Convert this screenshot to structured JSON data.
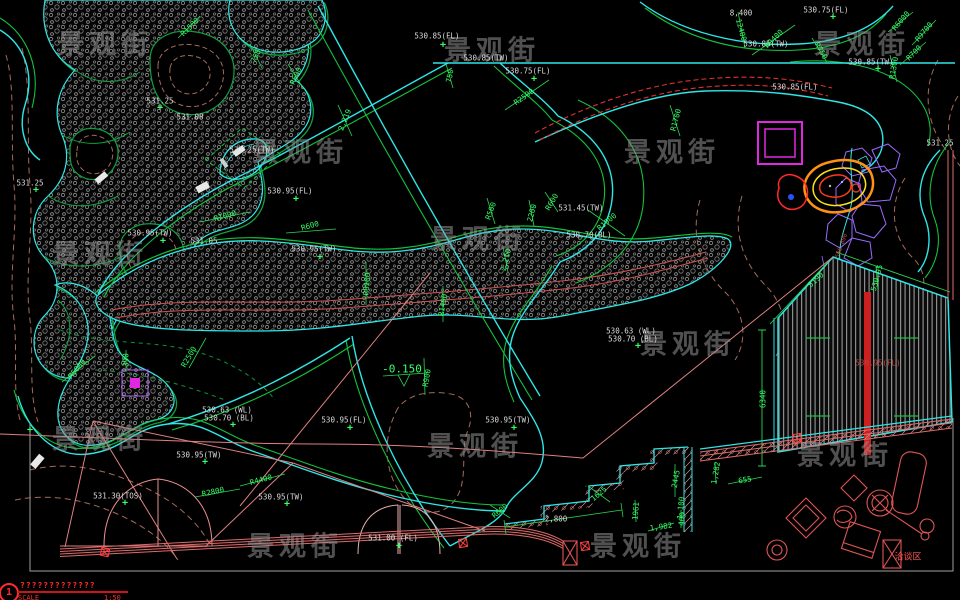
{
  "app": {
    "type": "cad-landscape-site-plan",
    "canvas_w": 960,
    "canvas_h": 600
  },
  "colors": {
    "background": "#000000",
    "edge_cyan": "#2ee6e6",
    "edge_green": "#12c23c",
    "label_green": "#35ff6a",
    "label_white": "#dcdcdc",
    "title_red": "#ff2a2a",
    "wall_pink": "#e06a6a",
    "contour_brown": "#a66a5a",
    "planter_magenta": "#e028e0",
    "rock_purple": "#9a6cff",
    "rock_orange": "#ff9114",
    "rock_yellow": "#ffe01a",
    "deck_red_band": "#cc2020",
    "watermark_gray": "#7a7a7a"
  },
  "watermark": {
    "text": "景观街",
    "positions": [
      [
        105,
        42
      ],
      [
        300,
        150
      ],
      [
        492,
        48
      ],
      [
        672,
        150
      ],
      [
        862,
        42
      ],
      [
        100,
        252
      ],
      [
        478,
        237
      ],
      [
        688,
        342
      ],
      [
        100,
        437
      ],
      [
        475,
        444
      ],
      [
        845,
        453
      ],
      [
        295,
        544
      ],
      [
        638,
        544
      ]
    ]
  },
  "title_block": {
    "sheet_no": "1",
    "glyph_row": "?????????????",
    "scale_label": "SCALE",
    "scale_value": "1:50"
  },
  "annotations": [
    {
      "t": "530.85(FL)",
      "x": 437,
      "y": 36,
      "c": "w"
    },
    {
      "t": "530.85(TW)",
      "x": 486,
      "y": 58,
      "c": "w"
    },
    {
      "t": "530.75(FL)",
      "x": 528,
      "y": 71,
      "c": "w"
    },
    {
      "t": "8,400",
      "x": 741,
      "y": 13,
      "c": "w"
    },
    {
      "t": "530.75(FL)",
      "x": 826,
      "y": 10,
      "c": "w"
    },
    {
      "t": "530.85(TW)",
      "x": 766,
      "y": 44,
      "c": "w"
    },
    {
      "t": "530.85(TW)",
      "x": 871,
      "y": 62,
      "c": "w"
    },
    {
      "t": "530.85(FL)",
      "x": 795,
      "y": 87,
      "c": "w"
    },
    {
      "t": "531.25",
      "x": 940,
      "y": 143,
      "c": "w"
    },
    {
      "t": "531.25",
      "x": 160,
      "y": 101,
      "c": "w"
    },
    {
      "t": "531.08",
      "x": 190,
      "y": 117,
      "c": "w"
    },
    {
      "t": "531.25(TW)",
      "x": 252,
      "y": 150,
      "c": "w"
    },
    {
      "t": "530.95(FL)",
      "x": 290,
      "y": 191,
      "c": "w"
    },
    {
      "t": "530.95(TW)",
      "x": 150,
      "y": 233,
      "c": "w"
    },
    {
      "t": "531.05",
      "x": 204,
      "y": 241,
      "c": "w"
    },
    {
      "t": "530.95(TW)",
      "x": 314,
      "y": 249,
      "c": "w"
    },
    {
      "t": "531.25",
      "x": 30,
      "y": 183,
      "c": "w"
    },
    {
      "t": "530.95(FL)",
      "x": 344,
      "y": 420,
      "c": "w"
    },
    {
      "t": "530.95(TW)",
      "x": 508,
      "y": 420,
      "c": "w"
    },
    {
      "t": "531.00 (FL)",
      "x": 393,
      "y": 538,
      "c": "w"
    },
    {
      "t": "530.63 (WL)",
      "x": 227,
      "y": 410,
      "c": "w"
    },
    {
      "t": "530.70 (BL)",
      "x": 229,
      "y": 418,
      "c": "w"
    },
    {
      "t": "530.63 (WL)",
      "x": 631,
      "y": 331,
      "c": "w"
    },
    {
      "t": "530.70 (BL)",
      "x": 633,
      "y": 339,
      "c": "w"
    },
    {
      "t": "530.95(TW)",
      "x": 199,
      "y": 455,
      "c": "w"
    },
    {
      "t": "530.95(TW)",
      "x": 281,
      "y": 497,
      "c": "w"
    },
    {
      "t": "531.30(TOS)",
      "x": 118,
      "y": 496,
      "c": "w"
    },
    {
      "t": "531.45(TW)",
      "x": 581,
      "y": 208,
      "c": "w"
    },
    {
      "t": "530.70(BL)",
      "x": 589,
      "y": 235,
      "c": "w"
    },
    {
      "t": "2,800",
      "x": 556,
      "y": 519,
      "c": "w"
    },
    {
      "t": "R2500",
      "x": 524,
      "y": 97,
      "c": "g",
      "r": -35
    },
    {
      "t": "R900",
      "x": 427,
      "y": 378,
      "c": "g",
      "r": -80
    },
    {
      "t": "-0.150",
      "x": 402,
      "y": 369,
      "c": "g",
      "s": 11
    },
    {
      "t": "R600",
      "x": 310,
      "y": 226,
      "c": "g",
      "r": -15
    },
    {
      "t": "R1000",
      "x": 225,
      "y": 216,
      "c": "g",
      "r": -15
    },
    {
      "t": "R8100",
      "x": 367,
      "y": 284,
      "c": "g",
      "r": -85
    },
    {
      "t": "R1400",
      "x": 443,
      "y": 305,
      "c": "g",
      "r": -80
    },
    {
      "t": "R500",
      "x": 491,
      "y": 211,
      "c": "g",
      "r": -70
    },
    {
      "t": "2,210",
      "x": 506,
      "y": 260,
      "c": "g",
      "r": -75
    },
    {
      "t": "R1900",
      "x": 607,
      "y": 222,
      "c": "g",
      "r": -40
    },
    {
      "t": "R600",
      "x": 552,
      "y": 202,
      "c": "g",
      "r": -60
    },
    {
      "t": "2200",
      "x": 532,
      "y": 213,
      "c": "g",
      "r": -75
    },
    {
      "t": "R2800",
      "x": 213,
      "y": 492,
      "c": "g",
      "r": -12
    },
    {
      "t": "R4400",
      "x": 261,
      "y": 480,
      "c": "g",
      "r": -15
    },
    {
      "t": "R600",
      "x": 500,
      "y": 511,
      "c": "g",
      "r": -40
    },
    {
      "t": "1625",
      "x": 599,
      "y": 494,
      "c": "g",
      "r": -40
    },
    {
      "t": "1961",
      "x": 636,
      "y": 511,
      "c": "g",
      "r": -85
    },
    {
      "t": "1,982",
      "x": 661,
      "y": 527,
      "c": "g",
      "r": -8
    },
    {
      "t": "1,100",
      "x": 681,
      "y": 508,
      "c": "g",
      "r": -85
    },
    {
      "t": "2445",
      "x": 676,
      "y": 479,
      "c": "g",
      "r": -80
    },
    {
      "t": "400",
      "x": 682,
      "y": 519,
      "c": "g",
      "r": -85
    },
    {
      "t": "1,282",
      "x": 716,
      "y": 473,
      "c": "g",
      "r": -80
    },
    {
      "t": "655",
      "x": 745,
      "y": 480,
      "c": "g",
      "r": -10
    },
    {
      "t": "6340",
      "x": 763,
      "y": 399,
      "c": "g",
      "r": -90
    },
    {
      "t": "5190",
      "x": 816,
      "y": 280,
      "c": "g",
      "r": -42
    },
    {
      "t": "530.95",
      "x": 877,
      "y": 278,
      "c": "g",
      "r": -75
    },
    {
      "t": "R9400",
      "x": 774,
      "y": 39,
      "c": "g",
      "r": -45
    },
    {
      "t": "12400",
      "x": 741,
      "y": 30,
      "c": "g",
      "r": 75
    },
    {
      "t": "R6000",
      "x": 901,
      "y": 21,
      "c": "g",
      "r": -50
    },
    {
      "t": "R9700",
      "x": 924,
      "y": 32,
      "c": "g",
      "r": -50
    },
    {
      "t": "R700",
      "x": 914,
      "y": 53,
      "c": "g",
      "r": -45
    },
    {
      "t": "R750",
      "x": 821,
      "y": 51,
      "c": "g",
      "r": 60
    },
    {
      "t": "R1300",
      "x": 894,
      "y": 68,
      "c": "g",
      "r": -80
    },
    {
      "t": "R1700",
      "x": 676,
      "y": 120,
      "c": "g",
      "r": -75
    },
    {
      "t": "2,219",
      "x": 345,
      "y": 120,
      "c": "g",
      "r": -68
    },
    {
      "t": "R1500",
      "x": 190,
      "y": 27,
      "c": "g",
      "r": -45
    },
    {
      "t": "750",
      "x": 256,
      "y": 56,
      "c": "g",
      "r": -65
    },
    {
      "t": "R600",
      "x": 296,
      "y": 76,
      "c": "g",
      "r": -65
    },
    {
      "t": "750",
      "x": 450,
      "y": 76,
      "c": "g",
      "r": -80
    },
    {
      "t": "R5000",
      "x": 77,
      "y": 369,
      "c": "g",
      "r": -50
    },
    {
      "t": "R2500",
      "x": 189,
      "y": 357,
      "c": "g",
      "r": -60
    },
    {
      "t": "390",
      "x": 126,
      "y": 360,
      "c": "g",
      "r": -90
    },
    {
      "t": "530.95(FL)",
      "x": 878,
      "y": 363,
      "c": "dr"
    },
    {
      "t": "500 800",
      "x": 842,
      "y": 246,
      "c": "dr",
      "r": -70,
      "s": 6
    },
    {
      "t": "洽谈区",
      "x": 908,
      "y": 558,
      "c": "r",
      "s": 9
    }
  ],
  "plus_markers": [
    [
      443,
      45
    ],
    [
      534,
      79
    ],
    [
      833,
      17
    ],
    [
      878,
      69
    ],
    [
      296,
      199
    ],
    [
      163,
      241
    ],
    [
      320,
      257
    ],
    [
      36,
      190
    ],
    [
      350,
      428
    ],
    [
      514,
      428
    ],
    [
      399,
      546
    ],
    [
      233,
      425
    ],
    [
      638,
      346
    ],
    [
      205,
      462
    ],
    [
      287,
      504
    ],
    [
      125,
      503
    ],
    [
      160,
      108
    ],
    [
      30,
      430
    ]
  ]
}
